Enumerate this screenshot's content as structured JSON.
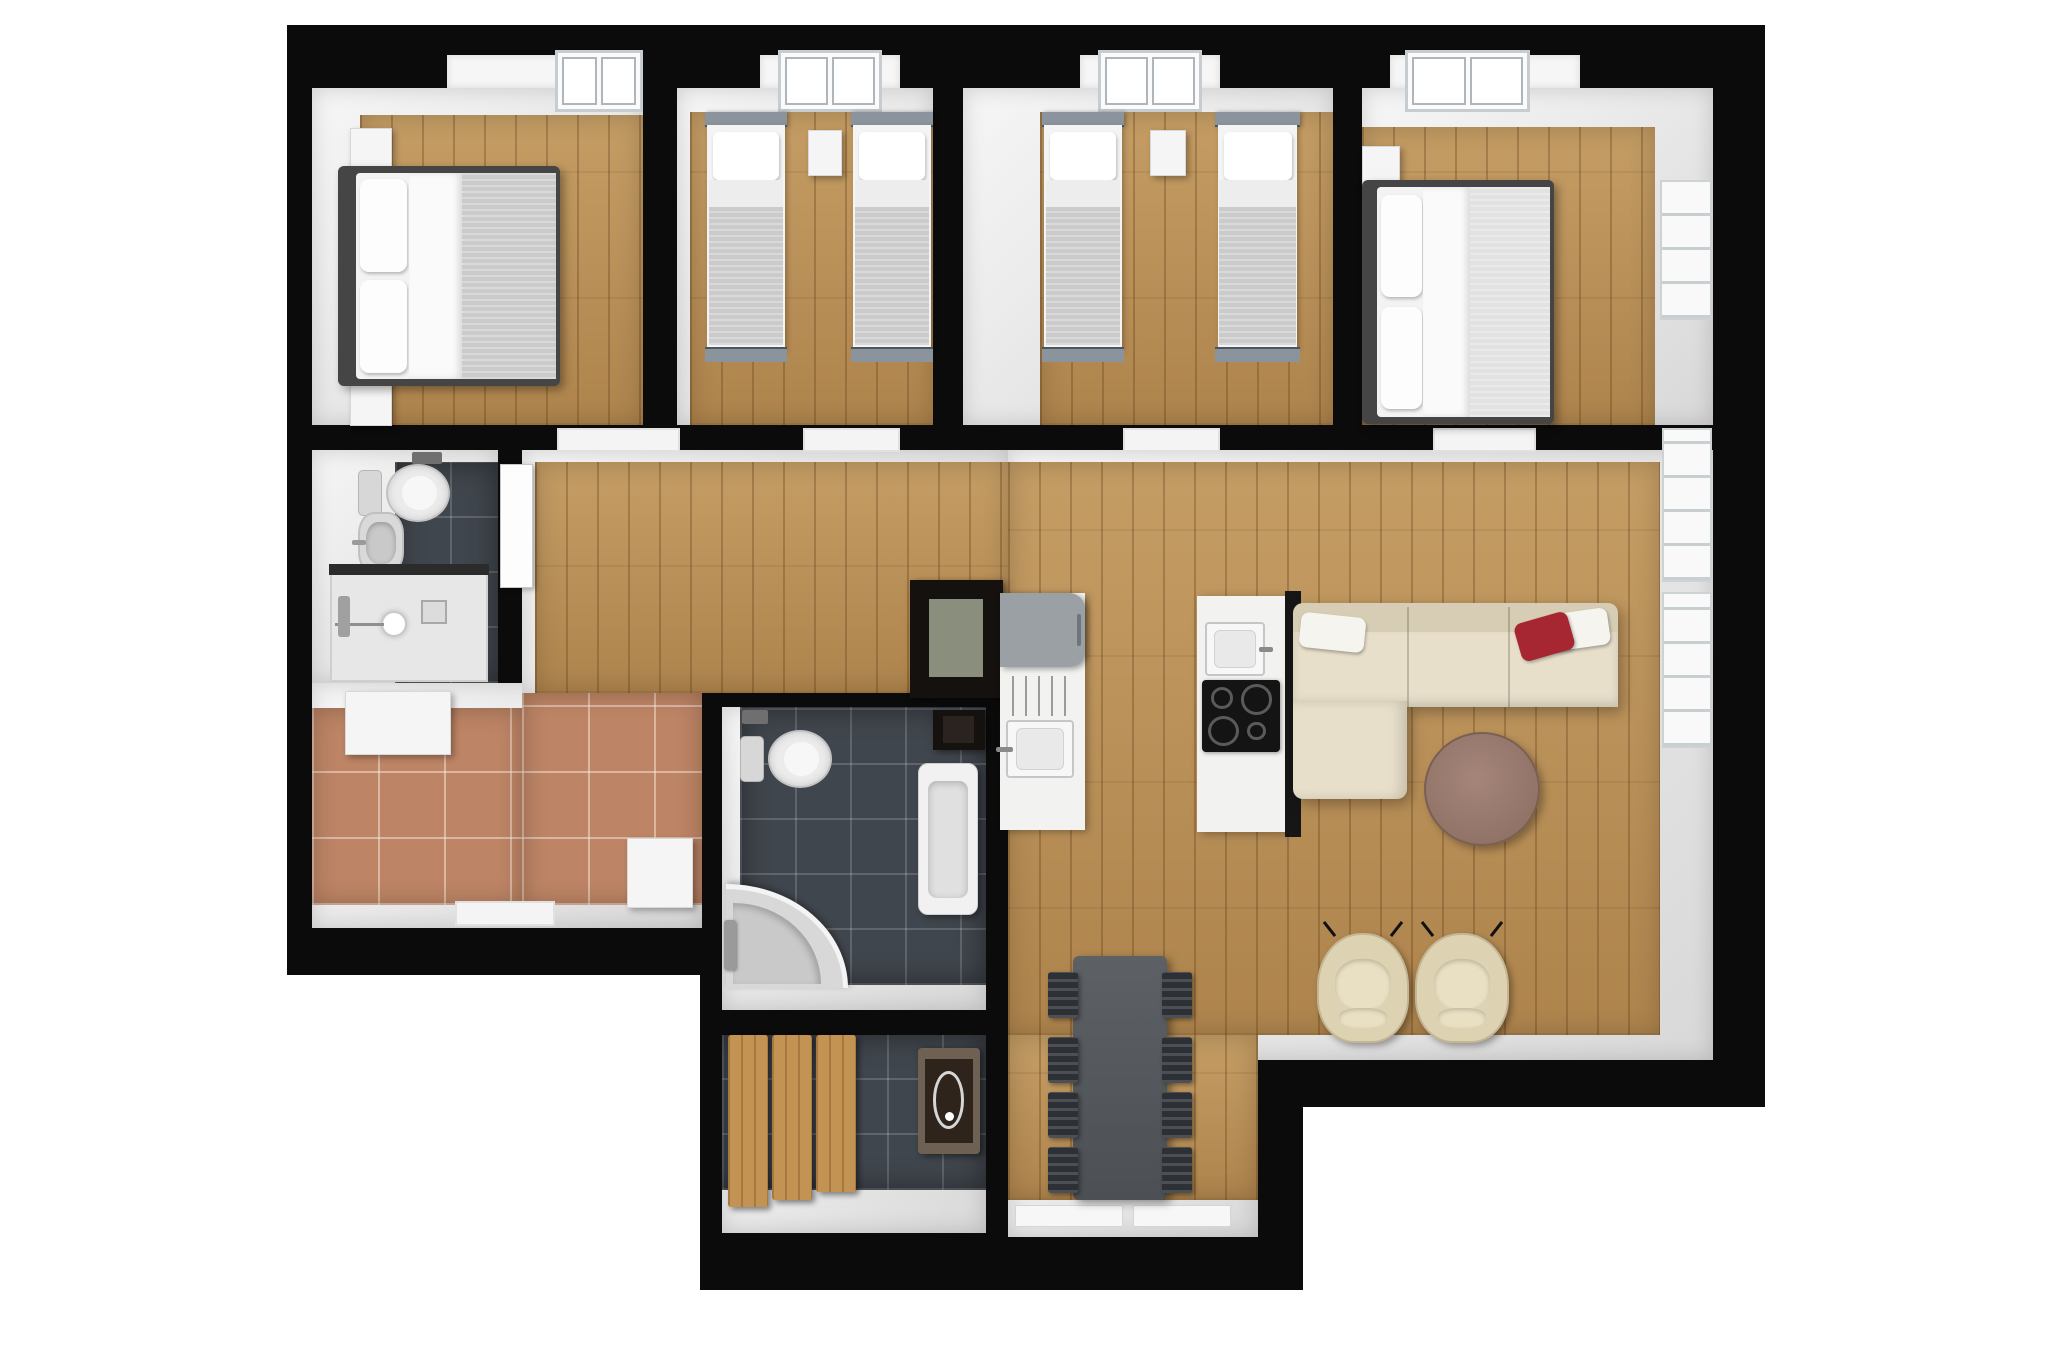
{
  "meta": {
    "description": "3D top-down floor plan rendering of an apartment with four bedrooms, two bathrooms, sauna, entrance hall, kitchen and open living-dining area",
    "rooms": [
      "bedroom-1-double",
      "bedroom-2-twin",
      "bedroom-3-twin",
      "bedroom-4-double",
      "bathroom-1",
      "entrance-hall",
      "hallway",
      "kitchen",
      "living-room",
      "dining-nook",
      "bathroom-2",
      "sauna"
    ]
  },
  "palette": {
    "background": "#ffffff",
    "wall": "#0b0b0b",
    "wood": "#b78d55",
    "tile-dark": "#40464d",
    "terracotta": "#bd8465",
    "bed-frame": "#454545",
    "headboard-gray": "#8b949c",
    "blanket-gray": "#cbcbcb",
    "sofa-beige": "#e7dfca",
    "sofa-beige-dark": "#d6cdb4",
    "pillow-red": "#a62631",
    "armchair-beige": "#ddd2b2",
    "dining-chair-dark": "#2d3035",
    "counter-white": "#f2f2f0",
    "appliance-gray": "#9ba0a5",
    "cooktop-black": "#141414",
    "sauna-wood": "#c29352",
    "heater-dark": "#2e241c"
  },
  "walls": [
    {
      "name": "wall-top",
      "x": 287,
      "y": 25,
      "w": 1478,
      "h": 63
    },
    {
      "name": "wall-left",
      "x": 287,
      "y": 25,
      "w": 25,
      "h": 950
    },
    {
      "name": "wall-right",
      "x": 1713,
      "y": 25,
      "w": 52,
      "h": 1082
    },
    {
      "name": "wall-bedrooms-south",
      "x": 287,
      "y": 425,
      "w": 1426,
      "h": 25
    },
    {
      "name": "wall-div-bedroom1-2",
      "x": 643,
      "y": 50,
      "w": 34,
      "h": 400
    },
    {
      "name": "wall-div-bedroom2-3",
      "x": 933,
      "y": 50,
      "w": 30,
      "h": 400
    },
    {
      "name": "wall-div-bedroom3-4",
      "x": 1333,
      "y": 50,
      "w": 29,
      "h": 400
    },
    {
      "name": "wall-bath1-east",
      "x": 498,
      "y": 450,
      "w": 24,
      "h": 235
    },
    {
      "name": "wall-bath1-south",
      "x": 287,
      "y": 683,
      "w": 235,
      "h": 25
    },
    {
      "name": "wall-entrance-south",
      "x": 287,
      "y": 928,
      "w": 435,
      "h": 47
    },
    {
      "name": "wall-block-west",
      "x": 700,
      "y": 685,
      "w": 22,
      "h": 605
    },
    {
      "name": "wall-block-north",
      "x": 700,
      "y": 685,
      "w": 308,
      "h": 22
    },
    {
      "name": "wall-block-east",
      "x": 986,
      "y": 685,
      "w": 22,
      "h": 605
    },
    {
      "name": "wall-block-mid",
      "x": 700,
      "y": 1010,
      "w": 308,
      "h": 25
    },
    {
      "name": "wall-block-south",
      "x": 700,
      "y": 1233,
      "w": 308,
      "h": 57
    },
    {
      "name": "wall-living-south",
      "x": 1295,
      "y": 1060,
      "w": 470,
      "h": 47
    },
    {
      "name": "wall-nook-east",
      "x": 1258,
      "y": 1060,
      "w": 45,
      "h": 230
    },
    {
      "name": "wall-nook-south",
      "x": 1008,
      "y": 1237,
      "w": 295,
      "h": 53
    }
  ],
  "areas": [
    {
      "name": "room-bedroom1-walls",
      "cls": "face",
      "x": 312,
      "y": 88,
      "w": 331,
      "h": 337
    },
    {
      "name": "room-bedroom2-walls",
      "cls": "face",
      "x": 677,
      "y": 88,
      "w": 256,
      "h": 337
    },
    {
      "name": "room-bedroom3-walls",
      "cls": "face",
      "x": 963,
      "y": 88,
      "w": 370,
      "h": 337
    },
    {
      "name": "room-bedroom4-walls",
      "cls": "face",
      "x": 1362,
      "y": 88,
      "w": 351,
      "h": 337
    },
    {
      "name": "room-bath1-walls",
      "cls": "face",
      "x": 312,
      "y": 450,
      "w": 186,
      "h": 233
    },
    {
      "name": "room-entrance-walls",
      "cls": "face",
      "x": 312,
      "y": 683,
      "w": 390,
      "h": 245
    },
    {
      "name": "room-hall-walls",
      "cls": "face",
      "x": 522,
      "y": 450,
      "w": 486,
      "h": 243
    },
    {
      "name": "room-living-walls",
      "cls": "face",
      "x": 1008,
      "y": 450,
      "w": 705,
      "h": 610
    },
    {
      "name": "room-nook-walls",
      "cls": "face",
      "x": 1008,
      "y": 1035,
      "w": 250,
      "h": 202
    },
    {
      "name": "room-bath2-walls",
      "cls": "face",
      "x": 722,
      "y": 707,
      "w": 264,
      "h": 303
    },
    {
      "name": "room-sauna-walls",
      "cls": "face",
      "x": 722,
      "y": 1035,
      "w": 264,
      "h": 198
    },
    {
      "name": "floor-bedroom1",
      "cls": "floor-wood",
      "x": 360,
      "y": 115,
      "w": 283,
      "h": 310
    },
    {
      "name": "floor-bedroom2",
      "cls": "floor-wood",
      "x": 690,
      "y": 112,
      "w": 243,
      "h": 313
    },
    {
      "name": "floor-bedroom3",
      "cls": "floor-wood",
      "x": 1040,
      "y": 112,
      "w": 293,
      "h": 313
    },
    {
      "name": "floor-bedroom4",
      "cls": "floor-wood",
      "x": 1362,
      "y": 127,
      "w": 293,
      "h": 298
    },
    {
      "name": "floor-bath1-tiles",
      "cls": "floor-tile-dark",
      "x": 395,
      "y": 462,
      "w": 103,
      "h": 221
    },
    {
      "name": "floor-entrance-tiles-a",
      "cls": "floor-terracotta",
      "x": 522,
      "y": 693,
      "w": 180,
      "h": 212
    },
    {
      "name": "floor-entrance-tiles-b",
      "cls": "floor-terracotta",
      "x": 312,
      "y": 708,
      "w": 210,
      "h": 197
    },
    {
      "name": "floor-hall",
      "cls": "floor-wood",
      "x": 535,
      "y": 462,
      "w": 473,
      "h": 231
    },
    {
      "name": "floor-living",
      "cls": "floor-wood",
      "x": 1008,
      "y": 462,
      "w": 652,
      "h": 573
    },
    {
      "name": "floor-nook",
      "cls": "floor-wood",
      "x": 1008,
      "y": 1035,
      "w": 250,
      "h": 165
    },
    {
      "name": "floor-bath2-tiles",
      "cls": "floor-tile-dark",
      "x": 740,
      "y": 707,
      "w": 246,
      "h": 278
    },
    {
      "name": "floor-sauna-tiles",
      "cls": "floor-tile-dark",
      "x": 722,
      "y": 1035,
      "w": 264,
      "h": 155
    }
  ],
  "openings": [
    {
      "name": "recess-bedroom1",
      "cls": "recess",
      "x": 447,
      "y": 55,
      "w": 196,
      "h": 33
    },
    {
      "name": "skylight-bedroom1",
      "cls": "skylight",
      "x": 555,
      "y": 50,
      "w": 88,
      "h": 62
    },
    {
      "name": "recess-bedroom2",
      "cls": "recess",
      "x": 760,
      "y": 55,
      "w": 140,
      "h": 33
    },
    {
      "name": "skylight-bedroom2",
      "cls": "skylight",
      "x": 778,
      "y": 50,
      "w": 104,
      "h": 62
    },
    {
      "name": "recess-bedroom3",
      "cls": "recess",
      "x": 1080,
      "y": 55,
      "w": 140,
      "h": 33
    },
    {
      "name": "skylight-bedroom3",
      "cls": "skylight",
      "x": 1098,
      "y": 50,
      "w": 104,
      "h": 62
    },
    {
      "name": "recess-bedroom4",
      "cls": "recess",
      "x": 1390,
      "y": 55,
      "w": 190,
      "h": 33
    },
    {
      "name": "skylight-bedroom4",
      "cls": "skylight",
      "x": 1405,
      "y": 50,
      "w": 125,
      "h": 62
    },
    {
      "name": "window-bedroom4-east",
      "cls": "window-v",
      "x": 1660,
      "y": 180,
      "w": 52,
      "h": 140
    },
    {
      "name": "door-threshold-bedroom1",
      "cls": "threshold",
      "x": 557,
      "y": 428,
      "w": 123,
      "h": 24
    },
    {
      "name": "door-threshold-bedroom2",
      "cls": "threshold",
      "x": 803,
      "y": 428,
      "w": 97,
      "h": 24
    },
    {
      "name": "door-threshold-bedroom3",
      "cls": "threshold",
      "x": 1123,
      "y": 428,
      "w": 97,
      "h": 24
    },
    {
      "name": "door-threshold-bedroom4",
      "cls": "threshold",
      "x": 1433,
      "y": 428,
      "w": 103,
      "h": 24
    },
    {
      "name": "door-leaf-hall",
      "cls": "door-leaf",
      "x": 500,
      "y": 464,
      "w": 33,
      "h": 124
    },
    {
      "name": "window-living-east-1",
      "cls": "window-v",
      "x": 1662,
      "y": 428,
      "w": 50,
      "h": 154
    },
    {
      "name": "window-living-east-2",
      "cls": "window-v",
      "x": 1662,
      "y": 592,
      "w": 50,
      "h": 156
    },
    {
      "name": "window-nook-south-1",
      "cls": "sill",
      "x": 1015,
      "y": 1205,
      "w": 108,
      "h": 22
    },
    {
      "name": "window-nook-south-2",
      "cls": "sill",
      "x": 1133,
      "y": 1205,
      "w": 98,
      "h": 22
    },
    {
      "name": "door-sill-entrance",
      "cls": "threshold",
      "x": 455,
      "y": 901,
      "w": 100,
      "h": 25
    }
  ],
  "furniture": [
    {
      "type": "nightstand",
      "name": "nightstand-bedroom1-north",
      "x": 350,
      "y": 128,
      "w": 42,
      "h": 46
    },
    {
      "type": "nightstand",
      "name": "nightstand-bedroom1-south",
      "x": 350,
      "y": 380,
      "w": 42,
      "h": 46
    },
    {
      "type": "bed-double",
      "name": "double-bed-bedroom1",
      "x": 338,
      "y": 166,
      "w": 222,
      "h": 220
    },
    {
      "type": "bed-twin",
      "name": "twin-bed-bedroom2-west",
      "x": 705,
      "y": 112,
      "w": 82,
      "h": 250
    },
    {
      "type": "nightstand",
      "name": "nightstand-bedroom2",
      "x": 808,
      "y": 130,
      "w": 34,
      "h": 46
    },
    {
      "type": "bed-twin",
      "name": "twin-bed-bedroom2-east",
      "x": 851,
      "y": 112,
      "w": 82,
      "h": 250
    },
    {
      "type": "bed-twin",
      "name": "twin-bed-bedroom3-west",
      "x": 1042,
      "y": 112,
      "w": 82,
      "h": 250
    },
    {
      "type": "nightstand",
      "name": "nightstand-bedroom3",
      "x": 1150,
      "y": 130,
      "w": 36,
      "h": 46
    },
    {
      "type": "bed-twin",
      "name": "twin-bed-bedroom3-east",
      "x": 1215,
      "y": 112,
      "w": 85,
      "h": 250
    },
    {
      "type": "nightstand",
      "name": "nightstand-bedroom4",
      "x": 1362,
      "y": 146,
      "w": 38,
      "h": 46
    },
    {
      "type": "bed-double",
      "name": "double-bed-bedroom4",
      "x": 1362,
      "y": 180,
      "w": 192,
      "h": 244,
      "variant": "light"
    },
    {
      "type": "tp-holder",
      "name": "toilet-paper-holder-bath1",
      "x": 412,
      "y": 452,
      "w": 30,
      "h": 12
    },
    {
      "type": "toilet",
      "name": "toilet-bath1",
      "x": 358,
      "y": 464,
      "w": 92,
      "h": 58
    },
    {
      "type": "sink-basin",
      "name": "washbasin-bath1",
      "x": 358,
      "y": 512,
      "w": 46,
      "h": 62
    },
    {
      "type": "shower-tray",
      "name": "shower-bath1",
      "x": 330,
      "y": 570,
      "w": 158,
      "h": 112
    },
    {
      "type": "cabinet-white",
      "name": "cabinet-entrance",
      "x": 345,
      "y": 691,
      "w": 106,
      "h": 64
    },
    {
      "type": "bench-white",
      "name": "bench-entrance",
      "x": 627,
      "y": 838,
      "w": 66,
      "h": 70
    },
    {
      "type": "cabinet-dark",
      "name": "tall-cabinet-kitchen",
      "x": 910,
      "y": 580,
      "w": 93,
      "h": 118
    },
    {
      "type": "counter",
      "name": "kitchen-counter",
      "x": 1000,
      "y": 593,
      "w": 85,
      "h": 237
    },
    {
      "type": "appliance-gray",
      "name": "kitchen-appliance",
      "x": 1000,
      "y": 593,
      "w": 85,
      "h": 74
    },
    {
      "type": "drainer",
      "name": "kitchen-drainer",
      "x": 1012,
      "y": 676,
      "w": 60,
      "h": 40
    },
    {
      "type": "sink-kitchen",
      "name": "kitchen-sink",
      "x": 1006,
      "y": 720,
      "w": 68,
      "h": 58,
      "variant": "tap-left"
    },
    {
      "type": "island",
      "name": "kitchen-island",
      "x": 1197,
      "y": 596,
      "w": 88,
      "h": 236
    },
    {
      "type": "sink-kitchen",
      "name": "island-sink",
      "x": 1205,
      "y": 622,
      "w": 60,
      "h": 54,
      "variant": "tap-right"
    },
    {
      "type": "cooktop",
      "name": "island-cooktop",
      "x": 1202,
      "y": 680,
      "w": 78,
      "h": 72
    },
    {
      "type": "sofa-l",
      "name": "sectional-sofa",
      "x": 1293,
      "y": 603,
      "w": 325,
      "h": 196
    },
    {
      "type": "coffee-table",
      "name": "coffee-table",
      "x": 1424,
      "y": 732,
      "w": 116,
      "h": 114
    },
    {
      "type": "armchair",
      "name": "armchair-west",
      "x": 1317,
      "y": 933,
      "w": 92,
      "h": 110
    },
    {
      "type": "armchair",
      "name": "armchair-east",
      "x": 1415,
      "y": 933,
      "w": 94,
      "h": 110
    },
    {
      "type": "dining-table",
      "name": "dining-table",
      "x": 1073,
      "y": 956,
      "w": 94,
      "h": 244
    },
    {
      "type": "dining-chair",
      "name": "dining-chair-west-1",
      "x": 1048,
      "y": 972,
      "w": 30,
      "h": 46
    },
    {
      "type": "dining-chair",
      "name": "dining-chair-west-2",
      "x": 1048,
      "y": 1037,
      "w": 30,
      "h": 46
    },
    {
      "type": "dining-chair",
      "name": "dining-chair-west-3",
      "x": 1048,
      "y": 1092,
      "w": 30,
      "h": 46
    },
    {
      "type": "dining-chair",
      "name": "dining-chair-west-4",
      "x": 1048,
      "y": 1147,
      "w": 30,
      "h": 46
    },
    {
      "type": "dining-chair",
      "name": "dining-chair-east-1",
      "x": 1162,
      "y": 972,
      "w": 30,
      "h": 46
    },
    {
      "type": "dining-chair",
      "name": "dining-chair-east-2",
      "x": 1162,
      "y": 1037,
      "w": 30,
      "h": 46
    },
    {
      "type": "dining-chair",
      "name": "dining-chair-east-3",
      "x": 1162,
      "y": 1092,
      "w": 30,
      "h": 46
    },
    {
      "type": "dining-chair",
      "name": "dining-chair-east-4",
      "x": 1162,
      "y": 1147,
      "w": 30,
      "h": 46
    },
    {
      "type": "tp-holder",
      "name": "toilet-paper-holder-bath2",
      "x": 742,
      "y": 710,
      "w": 26,
      "h": 14
    },
    {
      "type": "toilet",
      "name": "toilet-bath2",
      "x": 740,
      "y": 730,
      "w": 92,
      "h": 58
    },
    {
      "type": "cabinet-dark",
      "name": "cabinet-bath2",
      "x": 933,
      "y": 710,
      "w": 52,
      "h": 40,
      "variant": "solid"
    },
    {
      "type": "bathtub",
      "name": "bathtub-bath2",
      "x": 918,
      "y": 763,
      "w": 60,
      "h": 152
    },
    {
      "type": "shower-corner",
      "name": "corner-shower-bath2",
      "x": 726,
      "y": 884,
      "w": 122,
      "h": 104
    },
    {
      "type": "fixture-gray",
      "name": "shower-valve-bath2",
      "x": 724,
      "y": 920,
      "w": 12,
      "h": 50
    },
    {
      "type": "sauna-bench",
      "name": "sauna-bench-1",
      "x": 728,
      "y": 1035,
      "w": 40,
      "h": 172
    },
    {
      "type": "sauna-bench",
      "name": "sauna-bench-2",
      "x": 772,
      "y": 1035,
      "w": 40,
      "h": 165
    },
    {
      "type": "sauna-bench",
      "name": "sauna-bench-3",
      "x": 816,
      "y": 1035,
      "w": 40,
      "h": 157
    },
    {
      "type": "sauna-heater",
      "name": "sauna-heater",
      "x": 918,
      "y": 1048,
      "w": 62,
      "h": 106
    }
  ]
}
